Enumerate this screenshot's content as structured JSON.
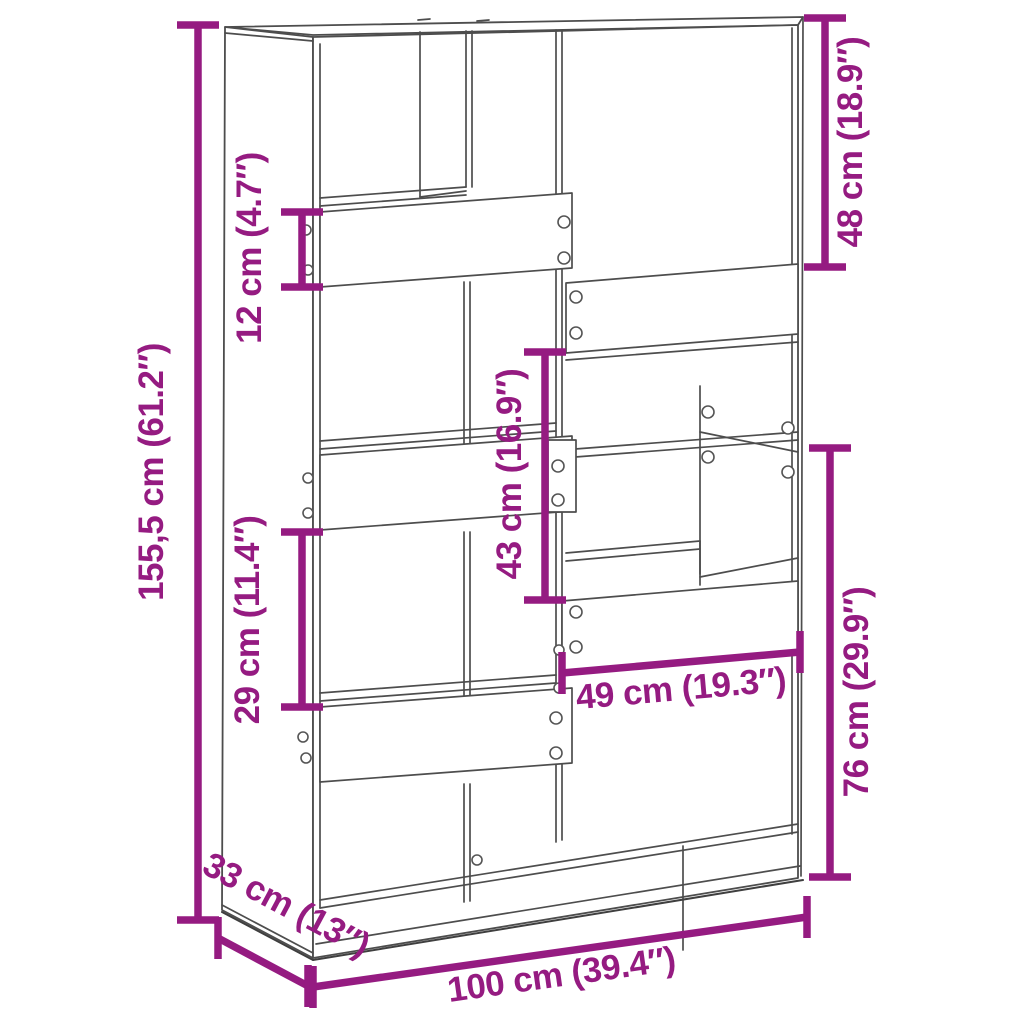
{
  "diagram": {
    "type": "furniture dimension diagram",
    "subject": "bookcase / room divider line drawing",
    "colors": {
      "dimension_accent": "#951B81",
      "outline": "#4d4d4d",
      "background": "#ffffff"
    },
    "dimensions": {
      "height": "155,5 cm (61.2″)",
      "top_left_shelf_height": "12 cm (4.7″)",
      "top_right_compartment_height": "48 cm (18.9″)",
      "center_compartment_height": "43 cm (16.9″)",
      "left_compartment_height": "29 cm (11.4″)",
      "bottom_right_section_height": "76 cm (29.9″)",
      "right_compartment_width": "49 cm (19.3″)",
      "depth": "33 cm (13″)",
      "width": "100 cm (39.4″)"
    }
  }
}
